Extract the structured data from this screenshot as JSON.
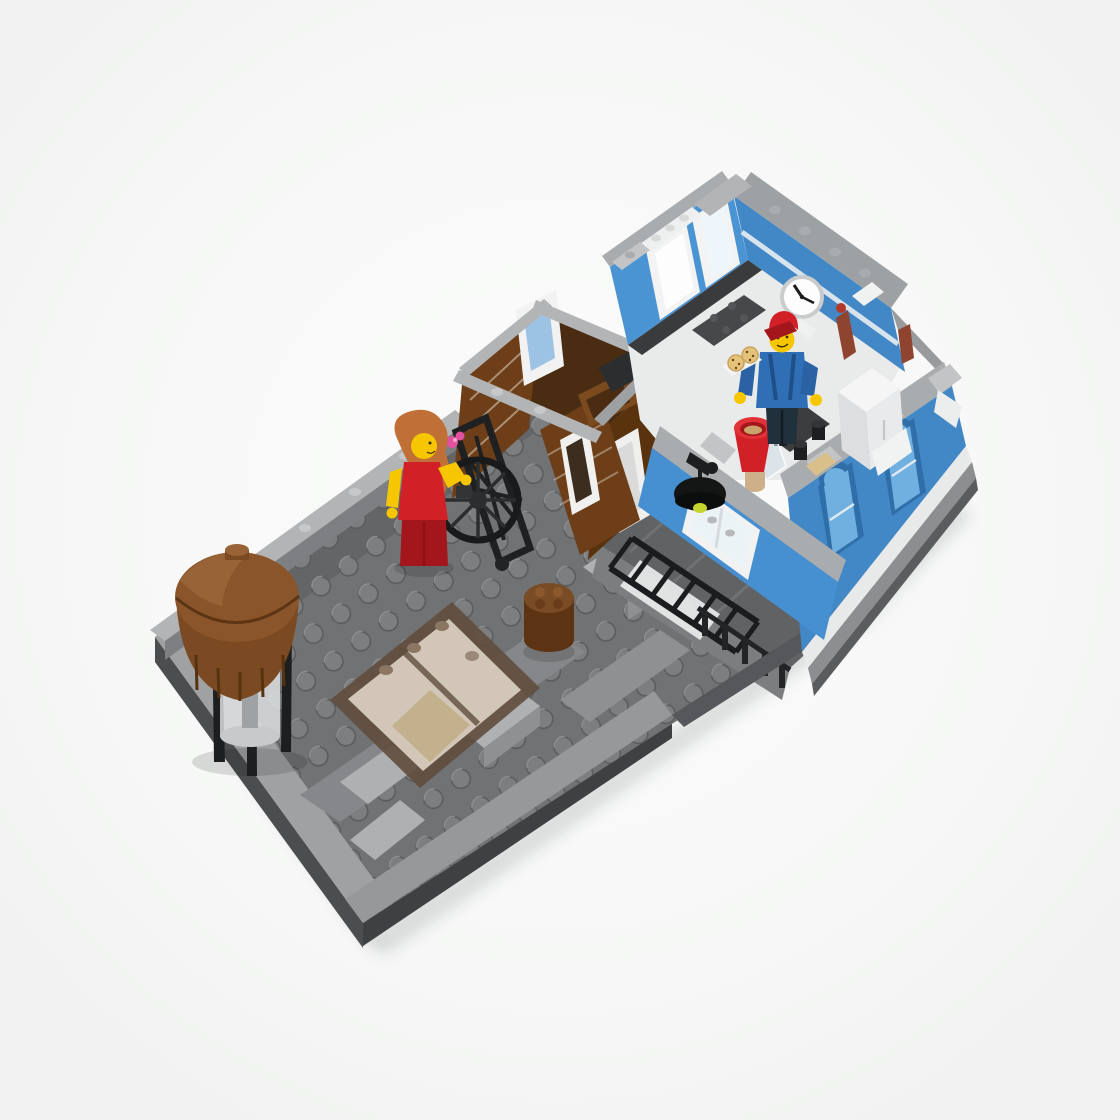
{
  "meta": {
    "type": "product-photo",
    "alt": "Top-down product photo of a LEGO modular building floor section: a rooftop terrace with a brown water tower, smoked-glass skylight and a woman minifigure in a red dress beside a black fire-escape wheel, attached to a blue-walled room with a wall clock, kitchen pieces and a minifigure in a red cap holding a tray of cookies"
  },
  "scene": {
    "objects": [
      {
        "id": "terrace-plate",
        "label": "dark gray studded rooftop terrace plate"
      },
      {
        "id": "water-tower",
        "label": "reddish-brown barrel water tower on black legs"
      },
      {
        "id": "skylight",
        "label": "transparent smoked-brown skylight box"
      },
      {
        "id": "small-barrel",
        "label": "small round brown barrel"
      },
      {
        "id": "woman-minifig",
        "label": "woman minifigure, orange hair, red dress"
      },
      {
        "id": "fire-escape-wheel",
        "label": "black fire-escape lattice with pulley wheel"
      },
      {
        "id": "flat-ladder",
        "label": "black ladder lying on lower roof"
      },
      {
        "id": "stair-shaft",
        "label": "reddish-brown open stair shaft with white door frames"
      },
      {
        "id": "blue-room",
        "label": "blue-walled interior room"
      },
      {
        "id": "wall-clock",
        "label": "white wall clock with black hands"
      },
      {
        "id": "chef-minifig",
        "label": "minifigure with red cap and blue jacket holding cookie tray"
      },
      {
        "id": "red-funnel",
        "label": "red funnel bucket"
      },
      {
        "id": "wall-lamp",
        "label": "black wall lamp with lime bulb"
      },
      {
        "id": "arched-windows",
        "label": "blue exterior wall with arched windows"
      }
    ]
  },
  "palette": {
    "bg0": "#fbfcfb",
    "bg1": "#f1f2f1",
    "shadow": "rgba(70,72,74,0.16)",
    "plate": "#707274",
    "plateRaised": "#636567",
    "stud": "#7c7e80",
    "studRim": "#595b5d",
    "borderA": "#9fa1a3",
    "borderB": "#96989a",
    "sideL": "#4b4d4f",
    "sideF": "#3e4042",
    "railTop": "#b2b4b6",
    "railFace": "#7d7f82",
    "railStud": "#c6c8ca",
    "stripA": "#85878a",
    "stripB": "#8e9092",
    "slab": "#aeb0b2",
    "slabSide": "#8e9092",
    "lg": "#a9acae",
    "lgTop": "#c2c4c6",
    "lgShade": "#8f9294",
    "lgDark": "#7b7e80",
    "lgBand": "#9ea1a3",
    "white": "#f2f3f2",
    "whiteShade": "#e0e2e2",
    "whiteBright": "#fdfdfd",
    "blue": "#4b94d4",
    "blueMid": "#4388c6",
    "blueDeep": "#2f6ea8",
    "blueFront": "#4690d2",
    "bluePanel": "#6fb0e0",
    "bluePale": "#9cc8e8",
    "brown": "#6d3e18",
    "brownShade": "#59320e",
    "brownDark": "#4a2c12",
    "brownLight": "#7b4a1e",
    "twDome": "#8a552a",
    "twDomeHi": "#986336",
    "twBody": "#7b4a22",
    "twStave": "#56320f",
    "barrel": "#7a4c26",
    "barrelDark": "#5d3413",
    "transFrame": "rgba(96,77,61,0.9)",
    "transGlass": "rgba(244,240,233,0.95)",
    "tint": "rgba(140,110,85,0.28)",
    "tan": "#d8c9a3",
    "board": "#d9c08a",
    "black": "#1d1e1f",
    "blackSoft": "#2c2d2e",
    "blackShade": "#141515",
    "red": "#d22027",
    "redDark": "#a3161c",
    "redBright": "#e23238",
    "yellow": "#f6c700",
    "hair": "#c06f36",
    "denim": "#2f6fb5",
    "denimDark": "#2b62a4",
    "pants": "#20303c",
    "cookie": "#e4c27a",
    "cookieDot": "#6b4318",
    "glass": "rgba(214,224,232,0.6)",
    "lime": "#c6d42e",
    "pink": "#e0519e",
    "pipe": "#8f4430",
    "clockFace": "#fdfdfd",
    "clockRim": "#c9cbcd",
    "fence": "#232425",
    "roofStrip": "#606264",
    "roofStripSide": "#7b7d7f",
    "jog": "#55575a",
    "foundation": "#8c8e90",
    "foundDark": "#5a5c5e",
    "floor": "#e9eaea",
    "floorDark": "#3a3b3c",
    "floorTile": "#47484a",
    "cabinet": "#f4f5f4",
    "cabinetFront": "#e9eaeb",
    "cabinetSide": "#dcdedf",
    "counter": "#3c3d3f",
    "content": "#caa46a",
    "cylGlass": "rgba(225,227,228,0.82)",
    "cylGlass2": "#c7c9ca"
  }
}
